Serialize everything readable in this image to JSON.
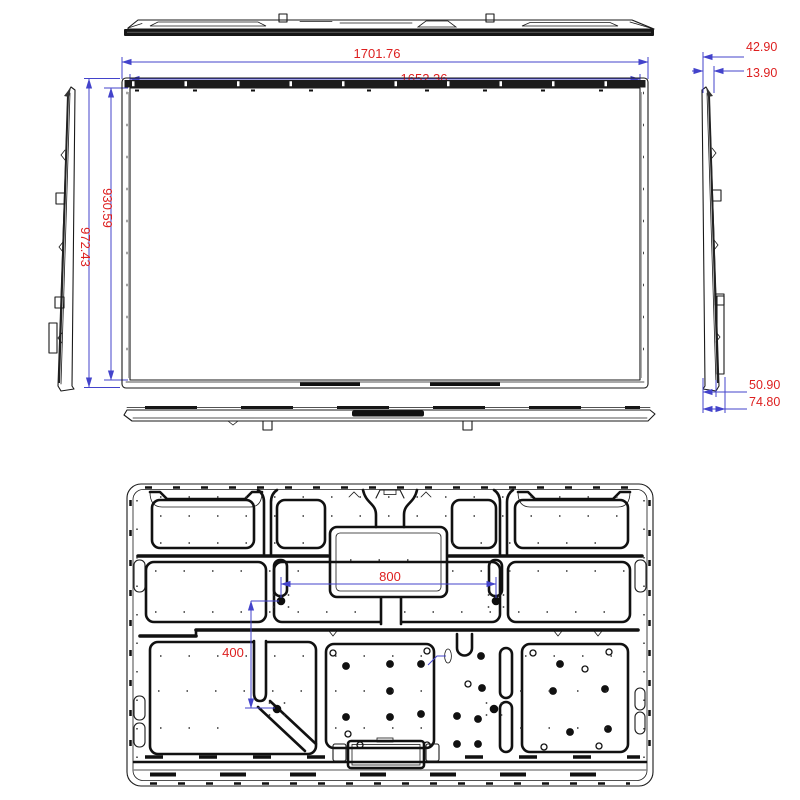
{
  "drawing": {
    "description": "Flat panel display engineering drawing with five orthographic views (top, front, left, right, bottom) and rear view with VESA mount pattern"
  },
  "dimensions": {
    "overall_width": "1701.76",
    "display_width": "1652.36",
    "display_height": "930.59",
    "overall_height": "972.43",
    "top_depth_a": "42.90",
    "top_depth_b": "13.90",
    "bottom_depth_a": "50.90",
    "bottom_depth_b": "74.80",
    "vesa_horizontal": "800",
    "vesa_vertical": "400"
  },
  "colors": {
    "dimension_line": "#4343cb",
    "dimension_text": "#dd1f1f",
    "drawing_outline": "#1a1a1a",
    "background": "#ffffff"
  }
}
